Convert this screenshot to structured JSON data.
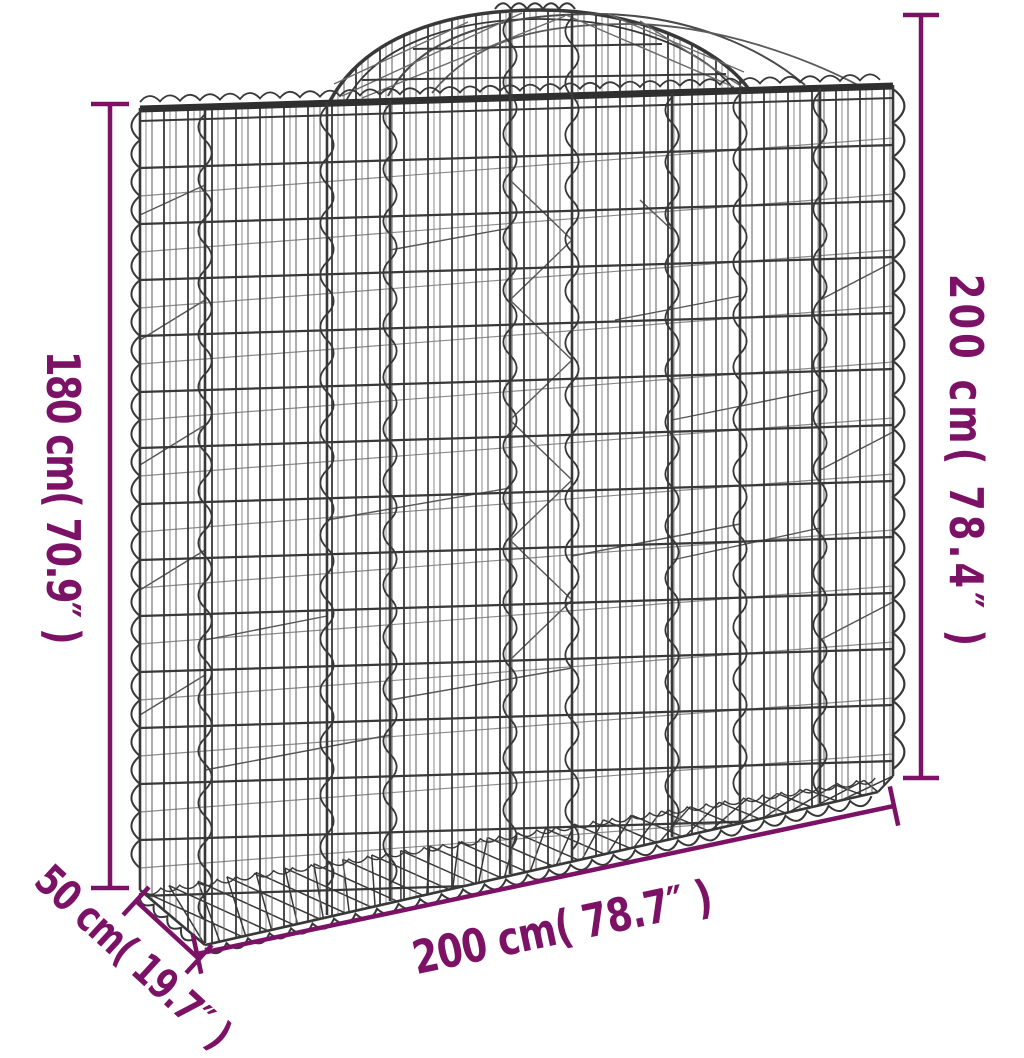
{
  "alt_text": "Arched gabion wire mesh basket dimension diagram",
  "annotations": {
    "left_height": "180 cm( 70.9″ )",
    "right_height": "200 cm( 78.4″ )",
    "bottom_width": "200 cm( 78.7″ )",
    "depth": "50 cm( 19.7″ )"
  },
  "colors": {
    "dimension_accent": "#7c1266",
    "wire_dark": "#383838",
    "wire_mid": "#6a6a6a",
    "wire_light": "#8c8c8c",
    "background": "#ffffff"
  }
}
